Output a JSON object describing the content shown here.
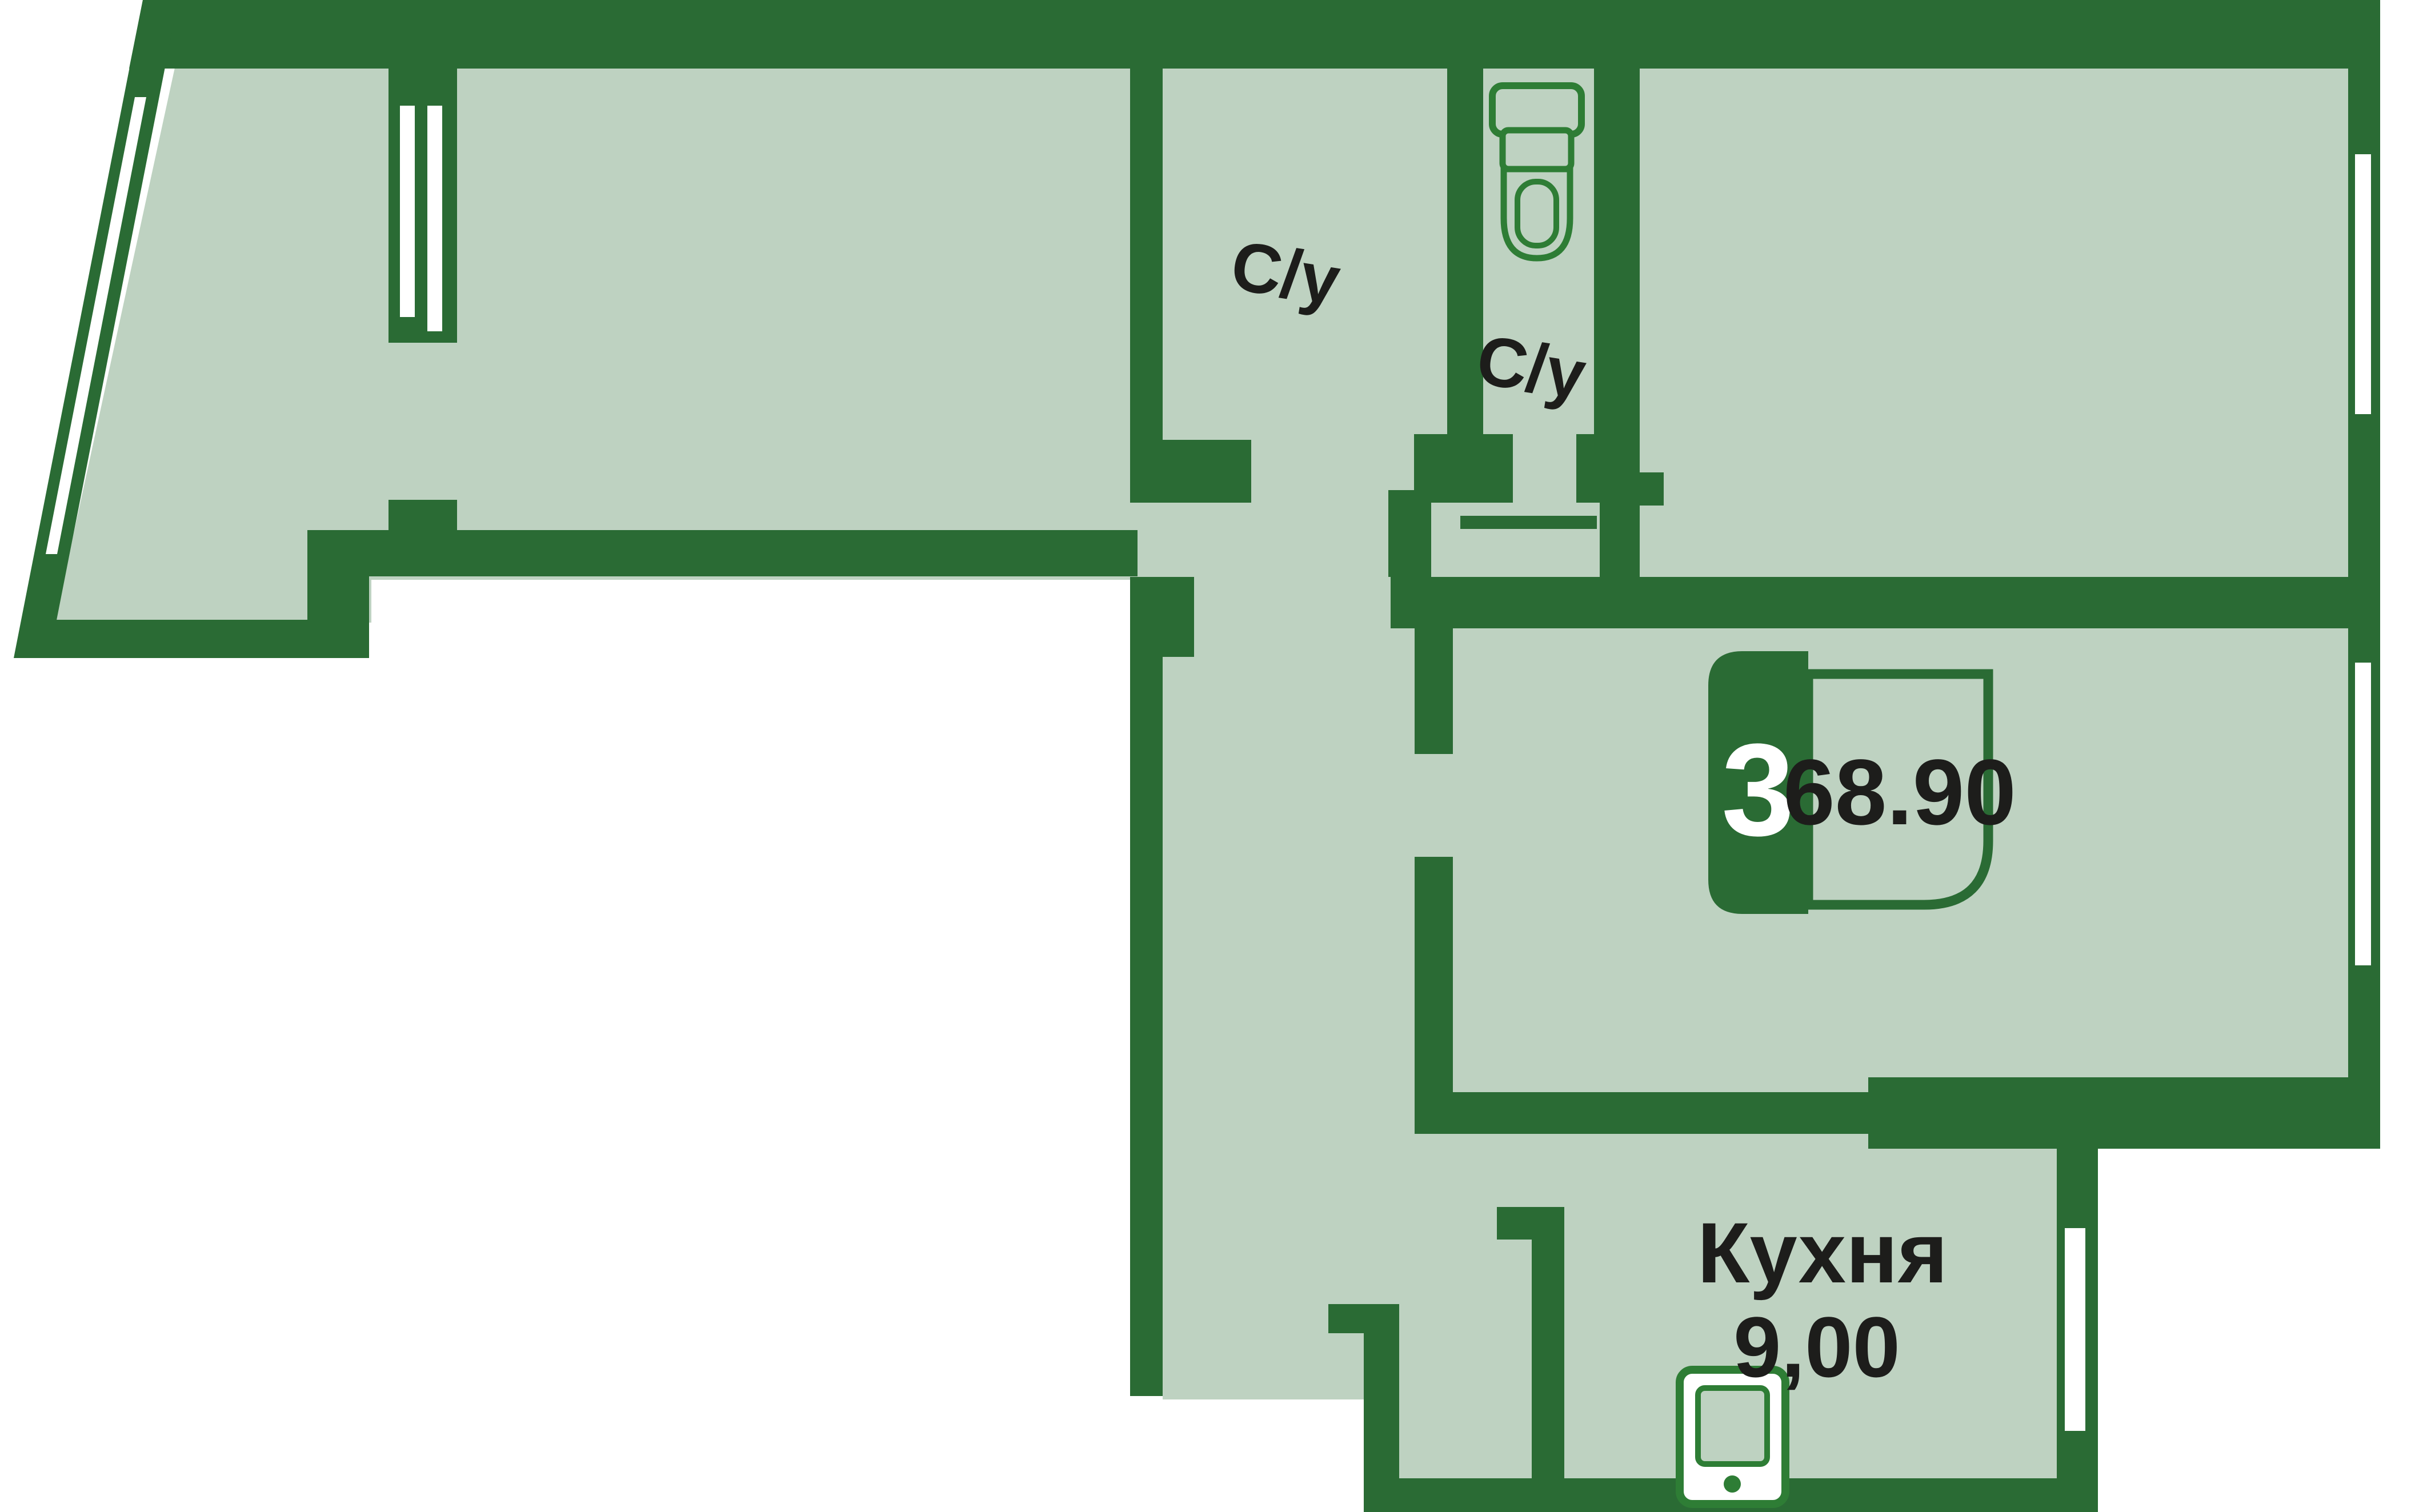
{
  "plan": {
    "title": "apartment-floor-plan",
    "type_badge": {
      "rooms": "3",
      "area": "68.90"
    },
    "labels": {
      "bathroom1": "С/у",
      "bathroom2": "С/у",
      "kitchen_name": "Кухня",
      "kitchen_area": "9,00"
    },
    "icons": [
      "toilet-icon",
      "stove-icon"
    ],
    "colors": {
      "wall": "#2a6b34",
      "floor": "#bed2c1",
      "fixture": "#2e7d35",
      "text": "#1d1d1b",
      "background": "#ffffff"
    }
  }
}
